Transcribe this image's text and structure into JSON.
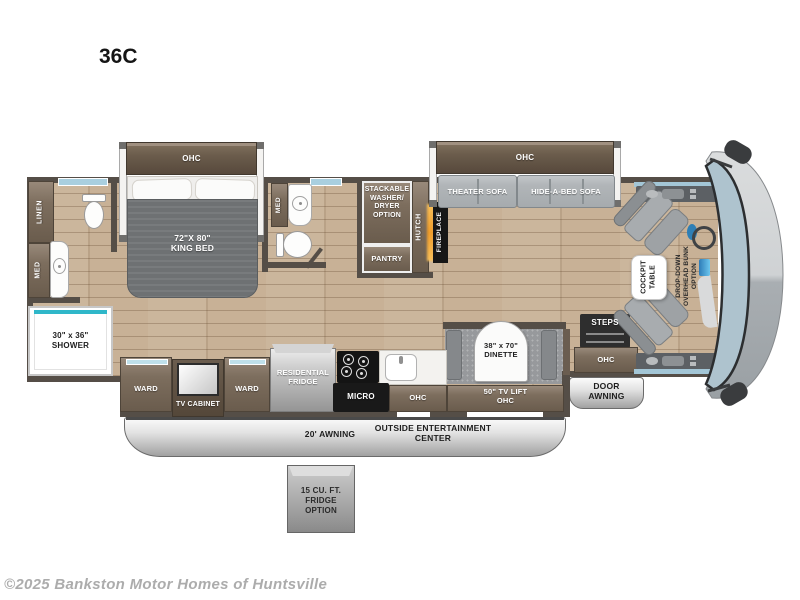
{
  "title": "36C",
  "watermark": "©2025 Bankston Motor Homes of Huntsville",
  "bedroom": {
    "ohc": "OHC",
    "bed": "72\"X 80\"\nKING BED"
  },
  "bath_front": {
    "linen": "LINEN",
    "med": "MED",
    "shower": "30\" x 36\"\nSHOWER"
  },
  "bath_mid": {
    "med": "MED"
  },
  "utility": {
    "washer": "STACKABLE\nWASHER/\nDRYER\nOPTION",
    "pantry": "PANTRY",
    "hutch": "HUTCH",
    "fireplace": "FIREPLACE"
  },
  "living": {
    "ohc": "OHC",
    "theater_sofa": "THEATER SOFA",
    "hide_a_bed_sofa": "HIDE-A-BED SOFA"
  },
  "cockpit": {
    "table": "COCKPIT\nTABLE",
    "bunk": "DROP-DOWN\nOVERHEAD BUNK\nOPTION",
    "steps": "STEPS"
  },
  "entry": {
    "ohc": "OHC",
    "door_awning": "DOOR\nAWNING"
  },
  "kitchen": {
    "ward_left": "WARD",
    "tv_cabinet": "TV CABINET",
    "ward_right": "WARD",
    "fridge": "RESIDENTIAL\nFRIDGE",
    "micro": "MICRO",
    "ohc": "OHC",
    "dinette": "38\" x 70\"\nDINETTE",
    "tv_lift": "50\" TV LIFT\nOHC"
  },
  "exterior": {
    "awning": "20' AWNING",
    "entertainment": "OUTSIDE ENTERTAINMENT\nCENTER",
    "fridge_option": "15 CU. FT.\nFRIDGE\nOPTION"
  },
  "colors": {
    "wood_floor": "#c8b196",
    "wall": "#554e47",
    "cabinet_brown": "#7d6e5e",
    "sofa_gray": "#b1b5b8",
    "glass_teal": "#2fb7c9",
    "windshield_blue": "#aec3ce",
    "fireplace_glow": "#f0a42f"
  }
}
